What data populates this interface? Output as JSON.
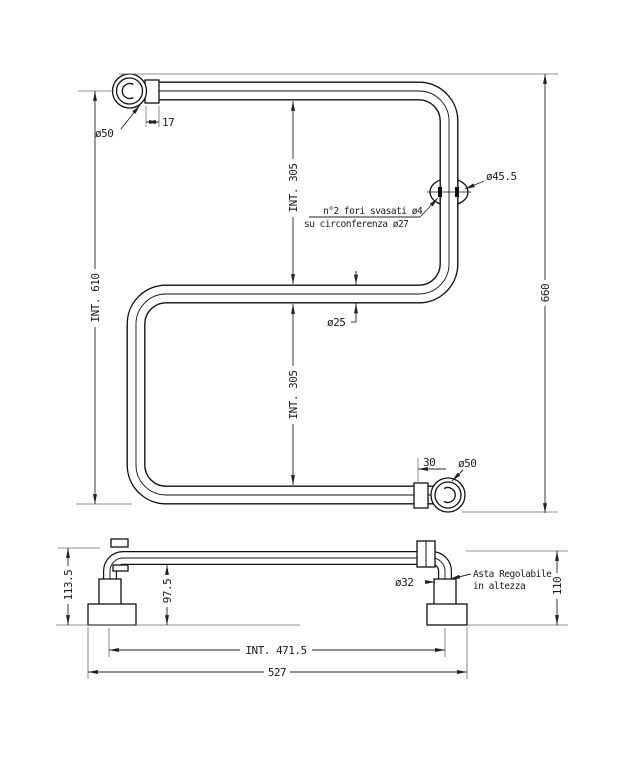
{
  "drawing": {
    "front_view": {
      "labels": {
        "bracket_top_diameter": "ø50",
        "collar_offset_top": "17",
        "internal_height_total": "INT. 610",
        "overall_height": "660",
        "upper_internal_gap": "INT. 305",
        "lower_internal_gap": "INT. 305",
        "hole_note_line1": "n°2 fori svasati ø4",
        "hole_note_line2": "su circonferenza ø27",
        "flange_diameter": "ø45.5",
        "tube_diameter": "ø25",
        "collar_offset_bottom": "30",
        "bracket_bottom_diameter": "ø50"
      }
    },
    "side_view": {
      "labels": {
        "height_tube_top_to_plate": "113.5",
        "height_tube_bottom_to_plate": "97.5",
        "rod_diameter": "ø32",
        "adjustable_note_line1": "Asta Regolabile",
        "adjustable_note_line2": "in altezza",
        "bracket_height": "110",
        "internal_width": "INT. 471.5",
        "overall_width": "527"
      }
    },
    "colors": {
      "line": "#111111",
      "dimension": "#222222",
      "extension": "#6e6e6e",
      "background": "#ffffff"
    }
  }
}
